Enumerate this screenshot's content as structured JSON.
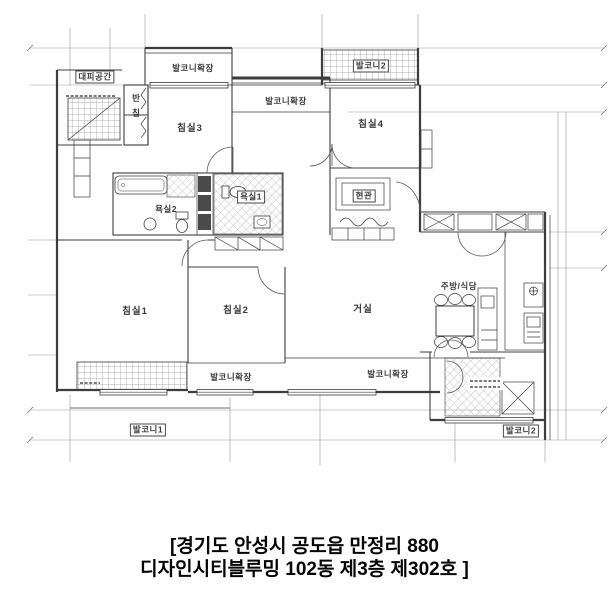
{
  "plan": {
    "line_color": "#3d3d3d",
    "labels": {
      "daepi": "대피공간",
      "balcony_ext_top_left": "발코니확장",
      "balcony2_top": "발코니2",
      "balcony_ext_top_center": "발코니확장",
      "bedroom3": "침실3",
      "bedroom4": "침실4",
      "banchim_char1": "반",
      "banchim_char2": "침",
      "bath2": "욕실2",
      "bath1": "욕실1",
      "entrance": "현관",
      "bedroom1": "침실1",
      "bedroom2": "침실2",
      "living": "거실",
      "kitchen_dining": "주방/식당",
      "balcony_ext_bottom_left": "발코니확장",
      "balcony_ext_bottom_center": "발코니확장",
      "balcony1": "발코니1",
      "balcony2_bottom": "발코니2"
    }
  },
  "caption": {
    "line1": "[경기도 안성시 공도읍 만정리 880",
    "line2": "디자인시티블루밍 102동 제3층 제302호 ]"
  }
}
